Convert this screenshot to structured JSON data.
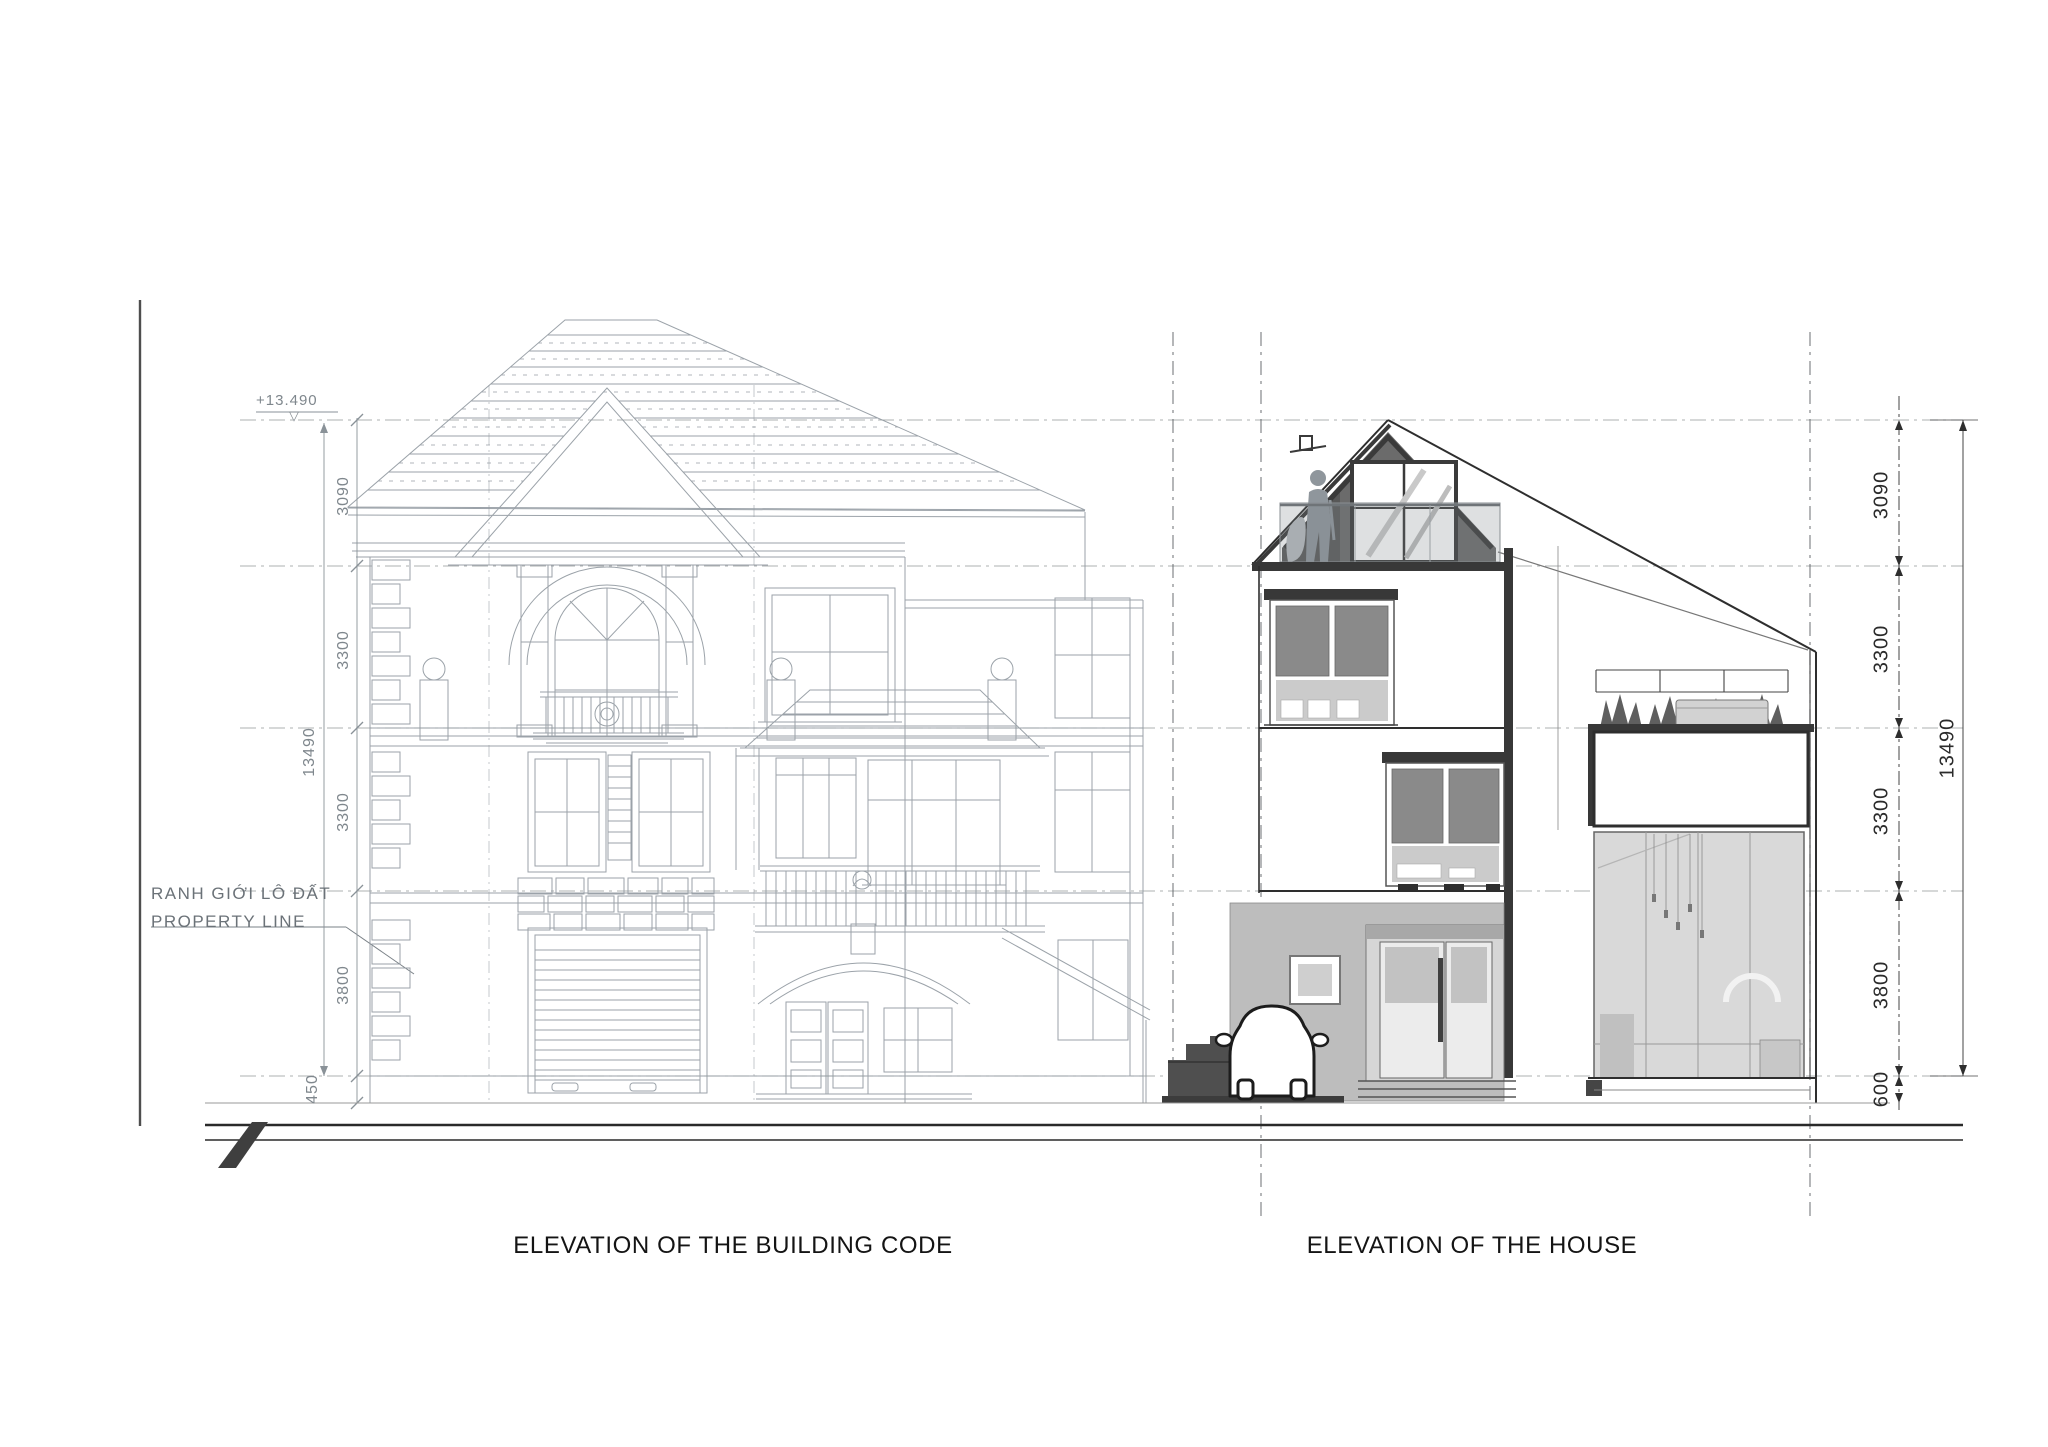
{
  "labels": {
    "left_caption": "ELEVATION OF THE BUILDING CODE",
    "right_caption": "ELEVATION OF THE HOUSE",
    "property_line_vi": "RANH GIỚI LÔ ĐẤT",
    "property_line_en": "PROPERTY LINE",
    "height_marker": "+13.490"
  },
  "icons": {
    "level_marker": "▽"
  },
  "dimensions": {
    "left": {
      "segments": [
        "3090",
        "3300",
        "3300",
        "3800",
        "450"
      ],
      "overall": "13490"
    },
    "right": {
      "segments": [
        "3090",
        "3300",
        "3300",
        "3800",
        "600"
      ],
      "overall": "13490"
    }
  },
  "colors": {
    "sketch": "#9199a0",
    "ink": "#2e2e2e",
    "glass": "#8a8a8a",
    "spandrel": "#cbcbcb",
    "ground_wall": "#bdbdbd",
    "slab": "#383838",
    "street": "#2a2a2a"
  }
}
